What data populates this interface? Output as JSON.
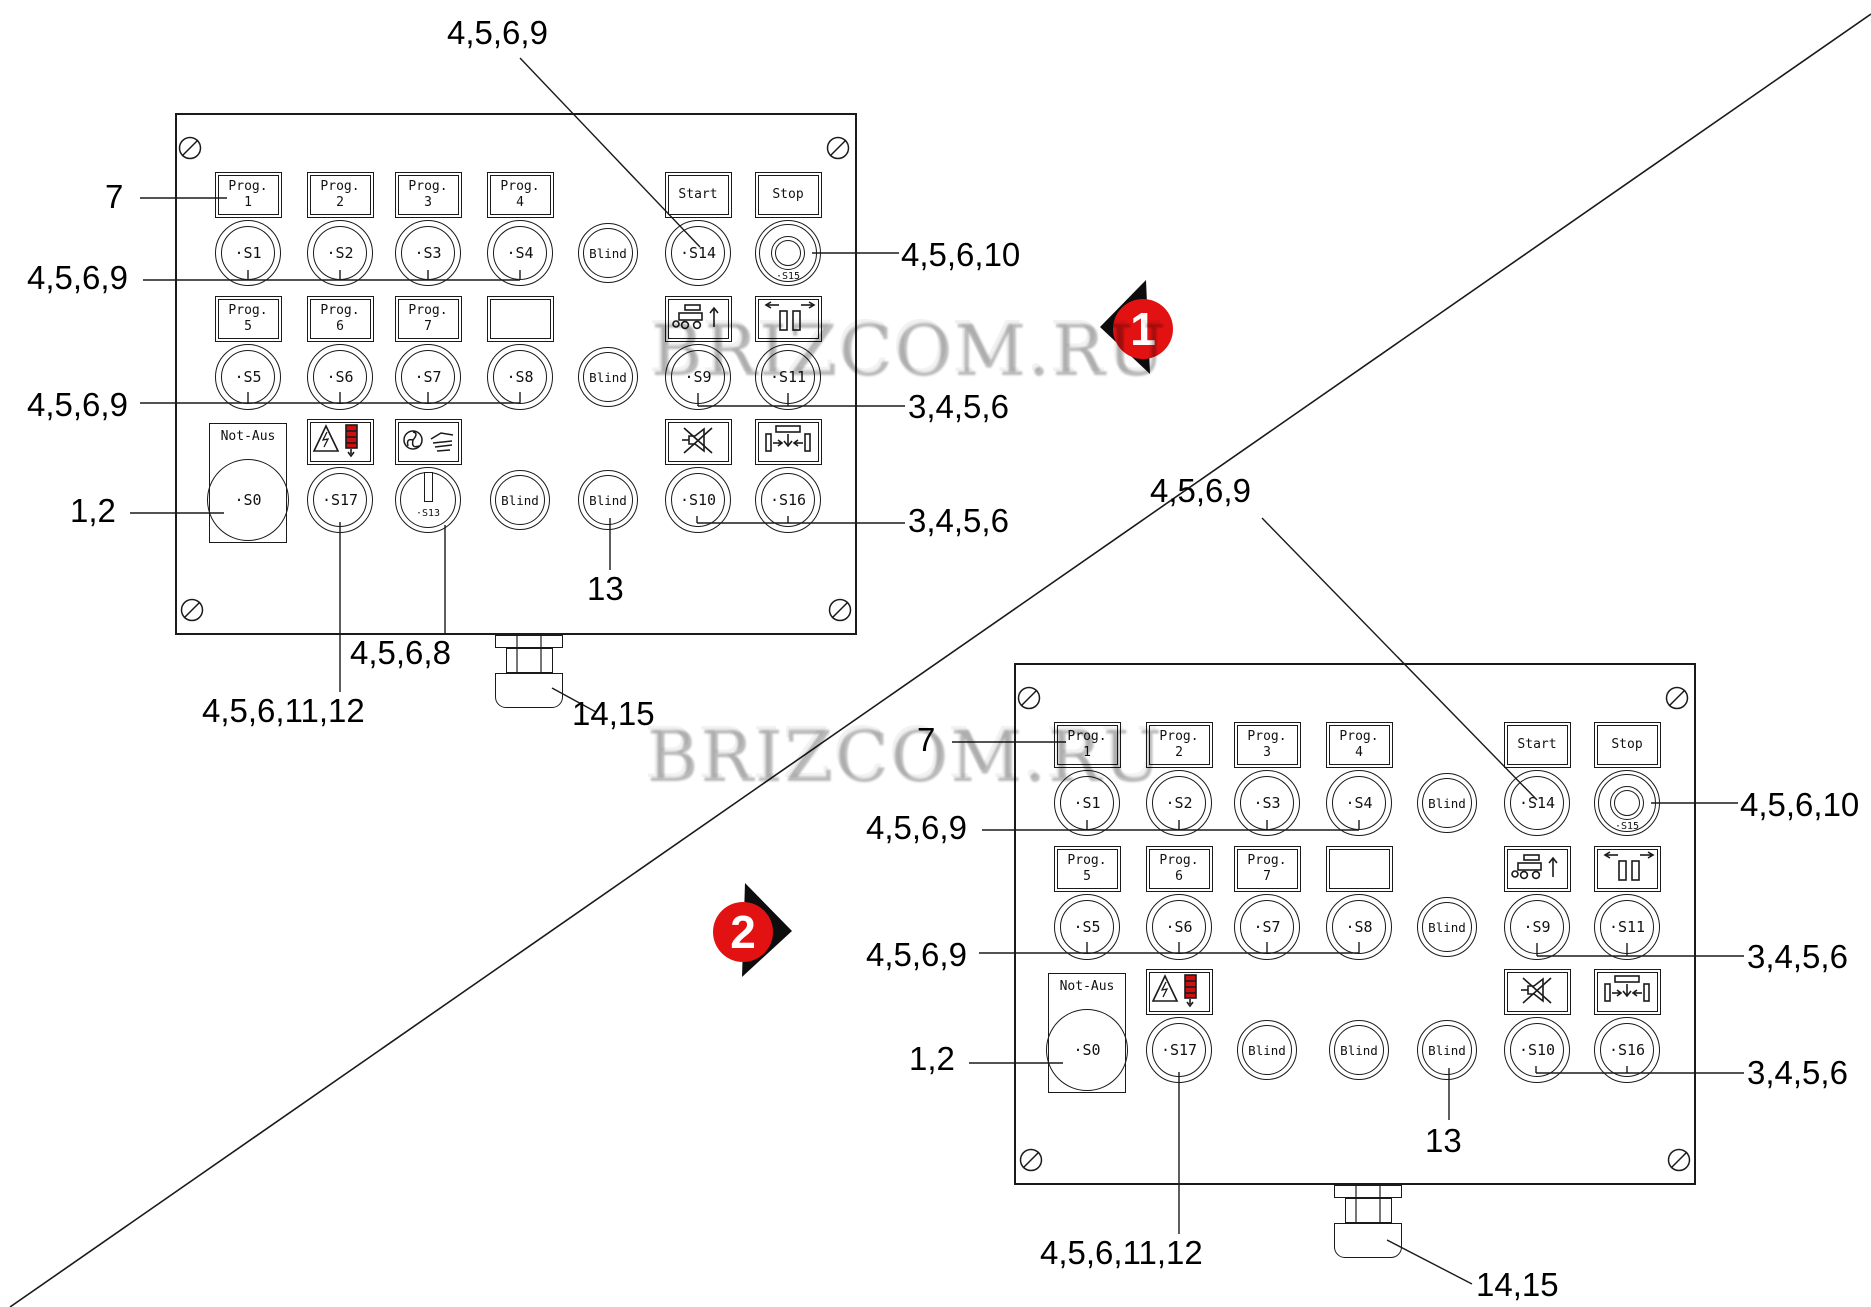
{
  "watermark": {
    "text": "BRIZCOM.RU"
  },
  "markers": [
    {
      "label": "1"
    },
    {
      "label": "2"
    }
  ],
  "colors": {
    "marker_red": "#e31212",
    "beacon_red": "#cc0f0f",
    "line": "#1a1a1a"
  },
  "panels": [
    {
      "name": "control-panel-1",
      "buttons": [
        {
          "id": "S1",
          "col": 1,
          "row": 1,
          "type": "push",
          "label": "·S1",
          "plate": {
            "kind": "text",
            "lines": [
              "Prog.",
              "1"
            ]
          }
        },
        {
          "id": "S2",
          "col": 2,
          "row": 1,
          "type": "push",
          "label": "·S2",
          "plate": {
            "kind": "text",
            "lines": [
              "Prog.",
              "2"
            ]
          }
        },
        {
          "id": "S3",
          "col": 3,
          "row": 1,
          "type": "push",
          "label": "·S3",
          "plate": {
            "kind": "text",
            "lines": [
              "Prog.",
              "3"
            ]
          }
        },
        {
          "id": "S4",
          "col": 4,
          "row": 1,
          "type": "push",
          "label": "·S4",
          "plate": {
            "kind": "text",
            "lines": [
              "Prog.",
              "4"
            ]
          }
        },
        {
          "id": "",
          "col": 5,
          "row": 1,
          "type": "blind",
          "label": "Blind"
        },
        {
          "id": "S14",
          "col": 6,
          "row": 1,
          "type": "push",
          "label": "·S14",
          "plate": {
            "kind": "text",
            "lines": [
              "Start"
            ]
          }
        },
        {
          "id": "S15",
          "col": 7,
          "row": 1,
          "type": "mushroom",
          "label": "·S15",
          "plate": {
            "kind": "text",
            "lines": [
              "Stop"
            ]
          }
        },
        {
          "id": "S5",
          "col": 1,
          "row": 2,
          "type": "push",
          "label": "·S5",
          "plate": {
            "kind": "text",
            "lines": [
              "Prog.",
              "5"
            ]
          }
        },
        {
          "id": "S6",
          "col": 2,
          "row": 2,
          "type": "push",
          "label": "·S6",
          "plate": {
            "kind": "text",
            "lines": [
              "Prog.",
              "6"
            ]
          }
        },
        {
          "id": "S7",
          "col": 3,
          "row": 2,
          "type": "push",
          "label": "·S7",
          "plate": {
            "kind": "text",
            "lines": [
              "Prog.",
              "7"
            ]
          }
        },
        {
          "id": "S8",
          "col": 4,
          "row": 2,
          "type": "push",
          "label": "·S8",
          "plate": {
            "kind": "empty"
          }
        },
        {
          "id": "",
          "col": 5,
          "row": 2,
          "type": "blind",
          "label": "Blind"
        },
        {
          "id": "S9",
          "col": 6,
          "row": 2,
          "type": "push",
          "label": "·S9",
          "plate": {
            "kind": "icon",
            "icon": "cart-up-icon"
          }
        },
        {
          "id": "S11",
          "col": 7,
          "row": 2,
          "type": "push",
          "label": "·S11",
          "plate": {
            "kind": "icon",
            "icon": "spread-open-icon"
          }
        },
        {
          "id": "S0",
          "col": 1,
          "row": 3,
          "type": "estop",
          "label": "·S0",
          "plate": {
            "kind": "estop",
            "lines": [
              "Not-Aus"
            ]
          }
        },
        {
          "id": "S17",
          "col": 2,
          "row": 3,
          "type": "push",
          "label": "·S17",
          "plate": {
            "kind": "icon",
            "icon": "electric-warning-beacon-icon"
          }
        },
        {
          "id": "S13",
          "col": 3,
          "row": 3,
          "type": "rotary",
          "label": "·S13",
          "plate": {
            "kind": "icon",
            "icon": "fan-hand-icon"
          }
        },
        {
          "id": "",
          "col": 4,
          "row": 3,
          "type": "blind",
          "label": "Blind"
        },
        {
          "id": "",
          "col": 5,
          "row": 3,
          "type": "blind",
          "label": "Blind"
        },
        {
          "id": "S10",
          "col": 6,
          "row": 3,
          "type": "push",
          "label": "·S10",
          "plate": {
            "kind": "icon",
            "icon": "mute-horn-icon"
          }
        },
        {
          "id": "S16",
          "col": 7,
          "row": 3,
          "type": "push",
          "label": "·S16",
          "plate": {
            "kind": "icon",
            "icon": "press-down-icon"
          }
        }
      ],
      "callouts": {
        "top": "4,5,6,9",
        "prog": "7",
        "row1": "4,5,6,9",
        "row2": "4,5,6,9",
        "estop": "1,2",
        "stop": "4,5,6,10",
        "r2right": "3,4,5,6",
        "r3right": "3,4,5,6",
        "blind13": "13",
        "s17": "4,5,6,11,12",
        "s13": "4,5,6,8",
        "gland": "14,15"
      }
    },
    {
      "name": "control-panel-2",
      "buttons": [
        {
          "id": "S1",
          "col": 1,
          "row": 1,
          "type": "push",
          "label": "·S1",
          "plate": {
            "kind": "text",
            "lines": [
              "Prog.",
              "1"
            ]
          }
        },
        {
          "id": "S2",
          "col": 2,
          "row": 1,
          "type": "push",
          "label": "·S2",
          "plate": {
            "kind": "text",
            "lines": [
              "Prog.",
              "2"
            ]
          }
        },
        {
          "id": "S3",
          "col": 3,
          "row": 1,
          "type": "push",
          "label": "·S3",
          "plate": {
            "kind": "text",
            "lines": [
              "Prog.",
              "3"
            ]
          }
        },
        {
          "id": "S4",
          "col": 4,
          "row": 1,
          "type": "push",
          "label": "·S4",
          "plate": {
            "kind": "text",
            "lines": [
              "Prog.",
              "4"
            ]
          }
        },
        {
          "id": "",
          "col": 5,
          "row": 1,
          "type": "blind",
          "label": "Blind"
        },
        {
          "id": "S14",
          "col": 6,
          "row": 1,
          "type": "push",
          "label": "·S14",
          "plate": {
            "kind": "text",
            "lines": [
              "Start"
            ]
          }
        },
        {
          "id": "S15",
          "col": 7,
          "row": 1,
          "type": "mushroom",
          "label": "·S15",
          "plate": {
            "kind": "text",
            "lines": [
              "Stop"
            ]
          }
        },
        {
          "id": "S5",
          "col": 1,
          "row": 2,
          "type": "push",
          "label": "·S5",
          "plate": {
            "kind": "text",
            "lines": [
              "Prog.",
              "5"
            ]
          }
        },
        {
          "id": "S6",
          "col": 2,
          "row": 2,
          "type": "push",
          "label": "·S6",
          "plate": {
            "kind": "text",
            "lines": [
              "Prog.",
              "6"
            ]
          }
        },
        {
          "id": "S7",
          "col": 3,
          "row": 2,
          "type": "push",
          "label": "·S7",
          "plate": {
            "kind": "text",
            "lines": [
              "Prog.",
              "7"
            ]
          }
        },
        {
          "id": "S8",
          "col": 4,
          "row": 2,
          "type": "push",
          "label": "·S8",
          "plate": {
            "kind": "empty"
          }
        },
        {
          "id": "",
          "col": 5,
          "row": 2,
          "type": "blind",
          "label": "Blind"
        },
        {
          "id": "S9",
          "col": 6,
          "row": 2,
          "type": "push",
          "label": "·S9",
          "plate": {
            "kind": "icon",
            "icon": "cart-up-icon"
          }
        },
        {
          "id": "S11",
          "col": 7,
          "row": 2,
          "type": "push",
          "label": "·S11",
          "plate": {
            "kind": "icon",
            "icon": "spread-open-icon"
          }
        },
        {
          "id": "S0",
          "col": 1,
          "row": 3,
          "type": "estop",
          "label": "·S0",
          "plate": {
            "kind": "estop",
            "lines": [
              "Not-Aus"
            ]
          }
        },
        {
          "id": "S17",
          "col": 2,
          "row": 3,
          "type": "push",
          "label": "·S17",
          "plate": {
            "kind": "icon",
            "icon": "electric-warning-beacon-icon"
          }
        },
        {
          "id": "",
          "col": 3,
          "row": 3,
          "type": "blind",
          "label": "Blind"
        },
        {
          "id": "",
          "col": 4,
          "row": 3,
          "type": "blind",
          "label": "Blind"
        },
        {
          "id": "",
          "col": 5,
          "row": 3,
          "type": "blind",
          "label": "Blind"
        },
        {
          "id": "S10",
          "col": 6,
          "row": 3,
          "type": "push",
          "label": "·S10",
          "plate": {
            "kind": "icon",
            "icon": "mute-horn-icon"
          }
        },
        {
          "id": "S16",
          "col": 7,
          "row": 3,
          "type": "push",
          "label": "·S16",
          "plate": {
            "kind": "icon",
            "icon": "press-down-icon"
          }
        }
      ],
      "callouts": {
        "top": "4,5,6,9",
        "prog": "7",
        "row1": "4,5,6,9",
        "row2": "4,5,6,9",
        "estop": "1,2",
        "stop": "4,5,6,10",
        "r2right": "3,4,5,6",
        "r3right": "3,4,5,6",
        "blind13": "13",
        "s17": "4,5,6,11,12",
        "gland": "14,15"
      }
    }
  ]
}
